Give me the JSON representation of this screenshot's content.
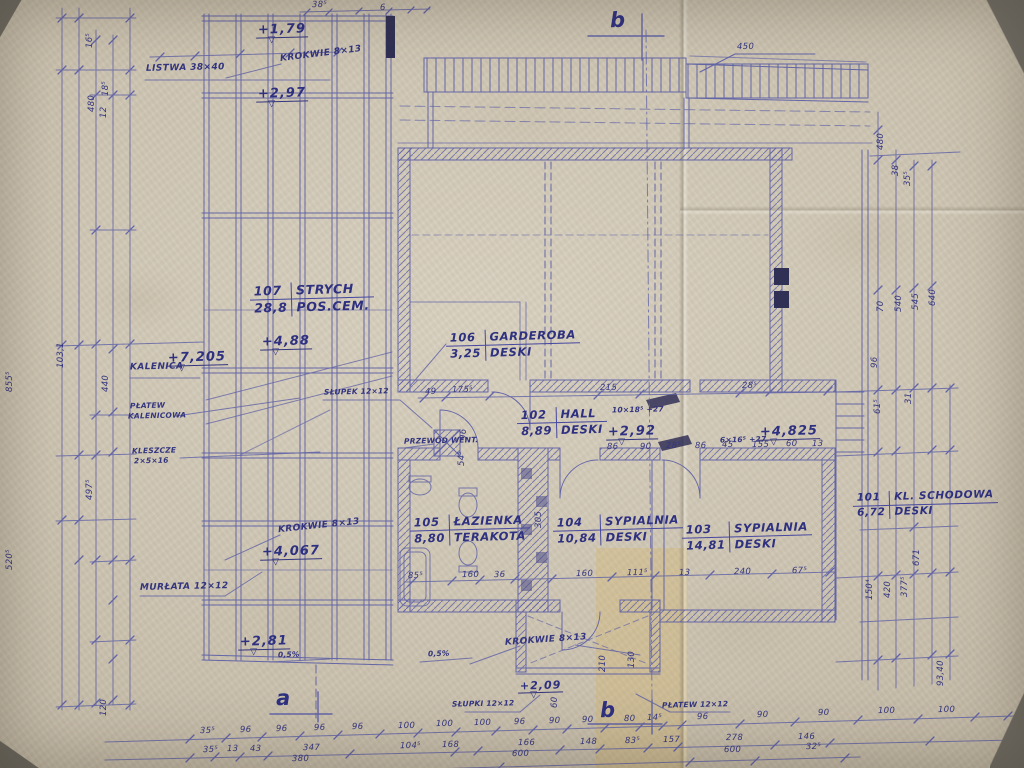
{
  "meta": {
    "drawing_type": "hand-drawn architectural blueprint, attic floor plan, photographed paper",
    "ink_color": "#5b5ea6",
    "text_color": "#33357e",
    "paper_color": "#cdc4b2"
  },
  "rooms": [
    {
      "number": "107",
      "name": "STRYCH",
      "area": "28,8",
      "finish": "POS.CEM."
    },
    {
      "number": "106",
      "name": "GARDEROBA",
      "area": "3,25",
      "finish": "DESKI"
    },
    {
      "number": "102",
      "name": "HALL",
      "area": "8,89",
      "finish": "DESKI"
    },
    {
      "number": "105",
      "name": "ŁAZIENKA",
      "area": "8,80",
      "finish": "TERAKOTA"
    },
    {
      "number": "104",
      "name": "SYPIALNIA",
      "area": "10,84",
      "finish": "DESKI"
    },
    {
      "number": "103",
      "name": "SYPIALNIA",
      "area": "14,81",
      "finish": "DESKI"
    },
    {
      "number": "101",
      "name": "KL. SCHODOWA",
      "area": "6,72",
      "finish": "DESKI"
    }
  ],
  "levels": {
    "v1": "+1,79",
    "v2": "+2,97",
    "v3": "+4,88",
    "v4": "+7,205",
    "v5": "+4,067",
    "v6": "+2,81",
    "v7": "+2,92",
    "v8": "+4,825",
    "v9": "+2,09"
  },
  "notes": {
    "listwa": "LISTWA 38×40",
    "krokwie1": "KROKWIE 8×13",
    "kalenica": "KALENICA",
    "platew1": "PŁATEW",
    "platew2": "KALENICOWA",
    "kleszcze1": "KLESZCZE",
    "kleszcze2": "2×5×16",
    "slupek": "SŁUPEK 12×12",
    "przewod": "PRZEWÓD WENT.",
    "krokwie2": "KROKWIE 8×13",
    "murlata": "MURŁATA 12×12",
    "krokwie3": "KROKWIE 8×13",
    "slupki": "SŁUPKI 12×12",
    "platew3": "PŁATEW 12×12",
    "spadek1": "0,5%",
    "spadek2": "0,5%",
    "stair1": "10×18⁵ +27",
    "stair2": "6×16⁵ +27"
  },
  "sections": {
    "a": "a",
    "b": "b"
  },
  "dims": {
    "top": [
      "38⁵",
      "6",
      "450"
    ],
    "left": [
      "16⁵",
      "480",
      "18⁵",
      "12",
      "855⁵",
      "103,1",
      "440",
      "497⁵",
      "520⁵",
      "120"
    ],
    "right": [
      "480",
      "38",
      "35⁵",
      "70",
      "540",
      "545",
      "640",
      "96",
      "61⁵",
      "31",
      "150⁴",
      "420",
      "377⁵",
      "671",
      "93,40"
    ],
    "hall1": [
      "49",
      "175⁵",
      "215",
      "28⁵"
    ],
    "hall2": [
      "86",
      "90",
      "28⁵",
      "86",
      "45",
      "155",
      "60",
      "13"
    ],
    "mid": [
      "85⁵",
      "160",
      "36",
      "160",
      "111⁵",
      "13",
      "240",
      "67⁵"
    ],
    "inner": [
      "96",
      "54⁵",
      "305",
      "210",
      "130",
      "60"
    ],
    "b1": [
      "35⁵",
      "96",
      "96",
      "96",
      "96",
      "100",
      "100",
      "100",
      "96",
      "90",
      "90",
      "80",
      "14⁵",
      "96",
      "90",
      "90",
      "100",
      "100"
    ],
    "b2": [
      "35⁵",
      "13",
      "43",
      "347",
      "104⁵",
      "168",
      "166",
      "148",
      "83⁵",
      "157",
      "278",
      "146"
    ],
    "b3": [
      "380",
      "600",
      "600",
      "32⁵"
    ]
  }
}
